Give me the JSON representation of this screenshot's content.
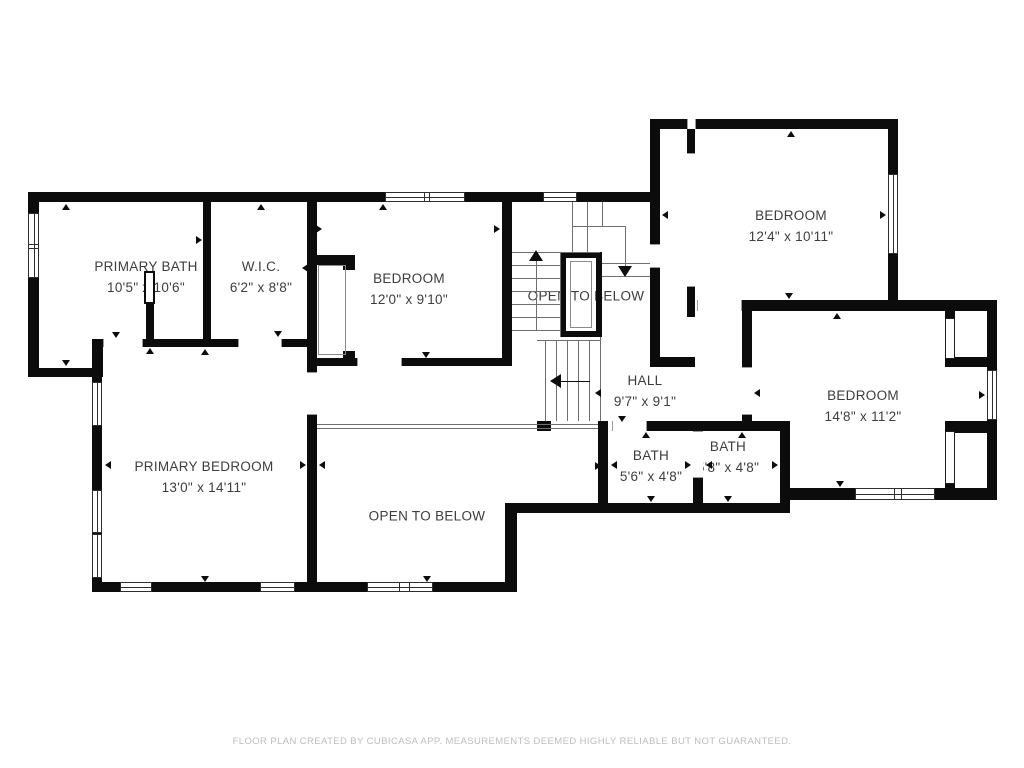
{
  "rooms": {
    "primary_bath": {
      "name": "PRIMARY BATH",
      "dims": "10'5\" x 10'6\""
    },
    "wic": {
      "name": "W.I.C.",
      "dims": "6'2\" x 8'8\""
    },
    "bedroom_top": {
      "name": "BEDROOM",
      "dims": "12'0\" x 9'10\""
    },
    "open_below_upper": {
      "name": "OPEN TO BELOW"
    },
    "bedroom_top_right": {
      "name": "BEDROOM",
      "dims": "12'4\" x 10'11\""
    },
    "hall": {
      "name": "HALL",
      "dims": "9'7\" x 9'1\""
    },
    "bedroom_right": {
      "name": "BEDROOM",
      "dims": "14'8\" x 11'2\""
    },
    "bath_left": {
      "name": "BATH",
      "dims": "5'6\" x 4'8\""
    },
    "bath_right": {
      "name": "BATH",
      "dims": "5'8\" x 4'8\""
    },
    "primary_bedroom": {
      "name": "PRIMARY BEDROOM",
      "dims": "13'0\" x 14'11\""
    },
    "open_below_lower": {
      "name": "OPEN TO BELOW"
    }
  },
  "footer": "FLOOR PLAN CREATED BY CUBICASA APP. MEASUREMENTS DEEMED HIGHLY RELIABLE BUT NOT GUARANTEED.",
  "colors": {
    "wall": "#0c0c0c",
    "label_text": "#3d3d3d",
    "stair_line": "#6f6f6f",
    "footer_text": "#bdbdbd"
  }
}
